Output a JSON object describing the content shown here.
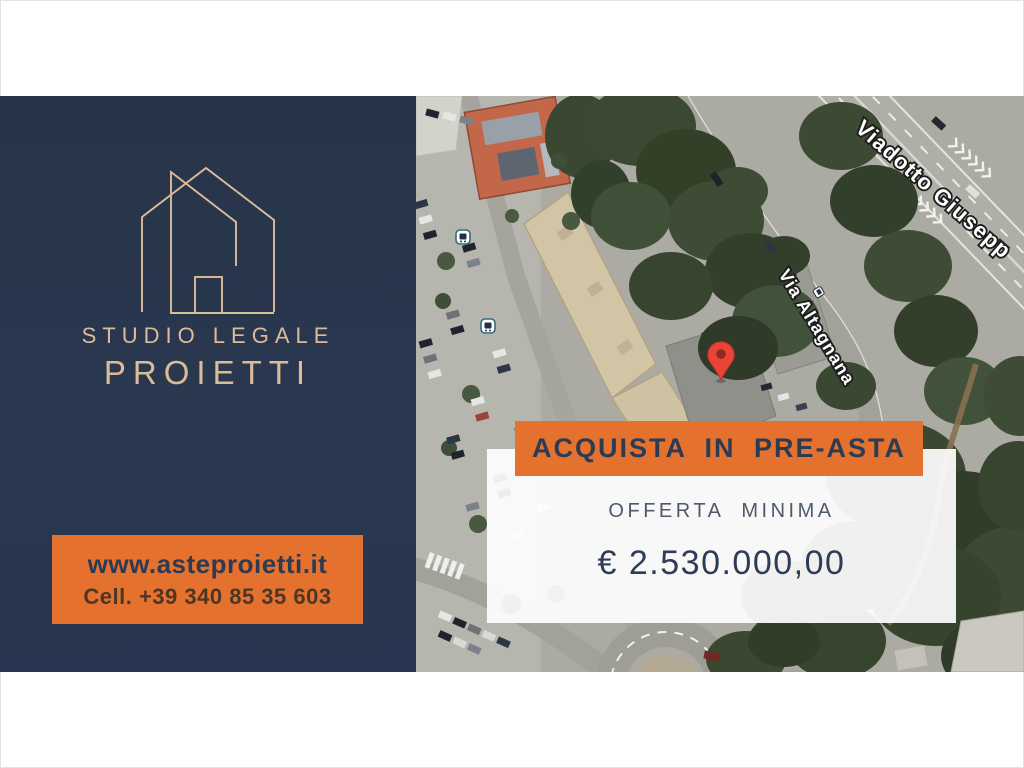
{
  "theme_colors": {
    "navy": "#273448",
    "orange": "#E5712F",
    "beige": "#DBBC99",
    "banner_text": "#2C3B54",
    "offer_label": "#4E5A6A",
    "offer_amount": "#2E3D55",
    "website": "#2C3A52",
    "phone": "#4E3626",
    "panel_white": "rgba(255,255,255,0.92)"
  },
  "brand_panel": {
    "logo_icon": "house-outline-icon",
    "studio_line1": "STUDIO LEGALE",
    "studio_line2": "PROIETTI",
    "contact": {
      "website": "www.asteproietti.it",
      "phone": "Cell. +39 340 85 35 603"
    }
  },
  "offer_overlay": {
    "banner_label": "ACQUISTA IN PRE-ASTA",
    "offer_label": "OFFERTA MINIMA",
    "offer_amount": "€ 2.530.000,00"
  },
  "map": {
    "type": "satellite-aerial-view",
    "street_labels": [
      {
        "text": "Viadotto Giusepp"
      },
      {
        "text": "Via Altagnana"
      }
    ],
    "marker": "red-location-pin",
    "poi_icons": [
      "bus-stop",
      "bus-stop"
    ]
  }
}
